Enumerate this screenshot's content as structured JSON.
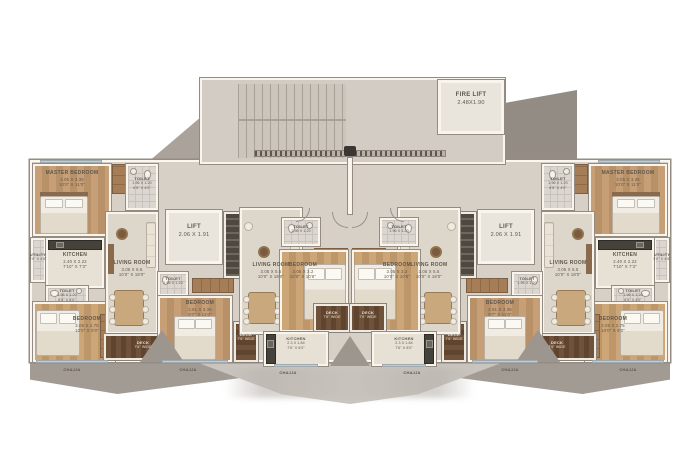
{
  "colors": {
    "wall": "#f9f5ed",
    "wall_line": "#948c83",
    "floor": "#d7d0c7",
    "floor_light": "#e6e0d5",
    "wood": "#c19a73",
    "deck_wood": "#6d5138",
    "tile": "#dbd6cf",
    "shadow": "#a29b94",
    "text": "#5f564a"
  },
  "rooms": {
    "fire_lift": {
      "name": "FIRE LIFT",
      "m": "2.48x1.90"
    },
    "lift": {
      "name": "LIFT",
      "m": "2.06 X 1.91"
    },
    "master_bedroom": {
      "name": "MASTER BEDROOM",
      "m": "3.05 X 3.35",
      "ft": "10'0\" X 11'0\""
    },
    "kitchen_main": {
      "name": "KITCHEN",
      "m": "2.40 X 2.22",
      "ft": "7'10\" X 7'3\""
    },
    "utility": {
      "name": "UTILITY",
      "ft": "3'0\" X 4'6\""
    },
    "toilet": {
      "name": "TOILET",
      "m": "1.96 X 1.20",
      "ft": "6'5\" X 4'0\""
    },
    "living_room": {
      "name": "LIVING ROOM",
      "m": "3.05 X 5.5",
      "ft": "10'0\" X 18'0\""
    },
    "bedroom_corner": {
      "name": "BEDROOM",
      "m": "3.05 X 2.75",
      "ft": "10'0\" X 9'0\""
    },
    "bedroom_mid": {
      "name": "BEDROOM",
      "m": "2.91 X 3.35",
      "ft": "9'7\" X 11'0\""
    },
    "bedroom_center": {
      "name": "BEDROOM",
      "m": "3.05 X 3.2",
      "ft": "10'0\" X 10'6\""
    },
    "kitchen_center": {
      "name": "KITCHEN",
      "m": "2.3 X 1.84",
      "ft": "7'6\" X 6'0\""
    },
    "deck": {
      "name": "DECK",
      "ft": "7'6\" WIDE"
    },
    "chajja": {
      "name": "CHAJJA"
    }
  }
}
